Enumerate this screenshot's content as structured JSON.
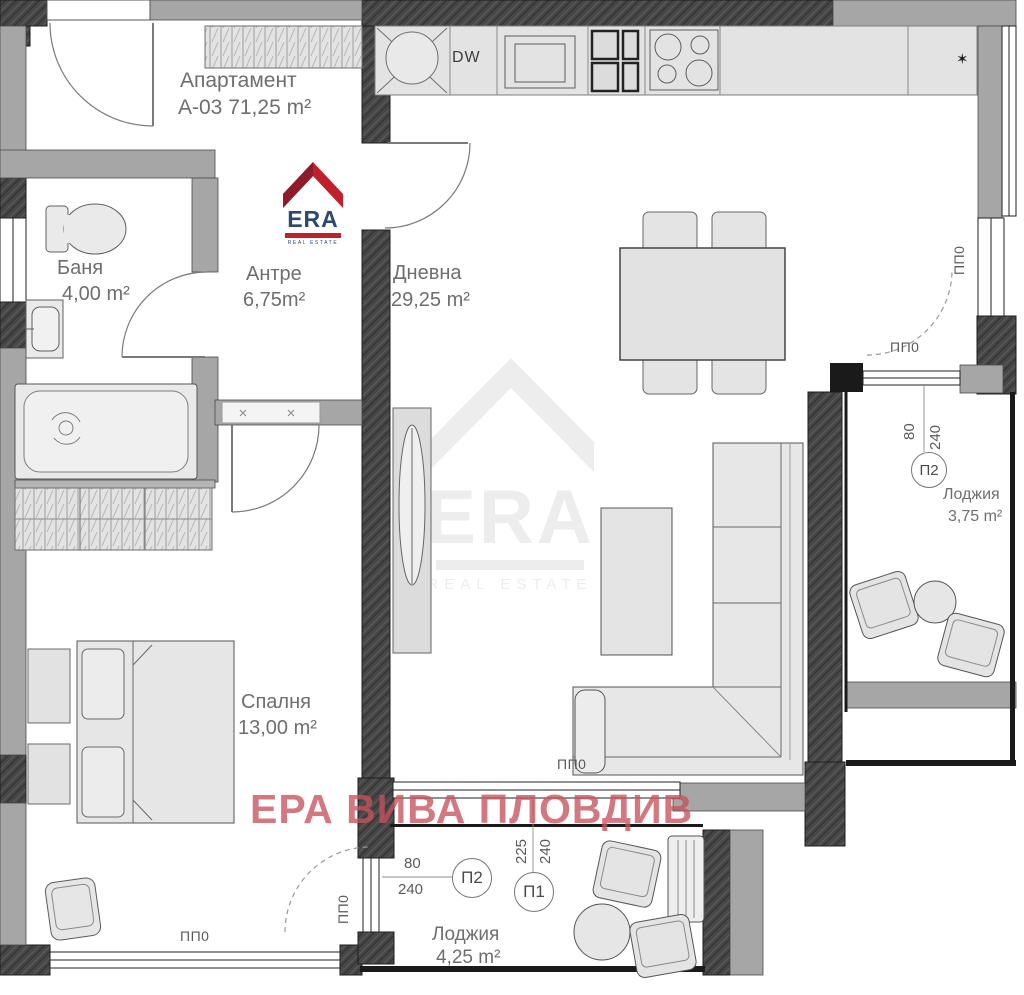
{
  "title": {
    "line1": "Апартамент",
    "line2": "А-03 71,25 m²"
  },
  "rooms": [
    {
      "name": "Баня",
      "area": "4,00 m²"
    },
    {
      "name": "Антре",
      "area": "6,75m²"
    },
    {
      "name": "Дневна",
      "area": "29,25 m²"
    },
    {
      "name": "Спалня",
      "area": "13,00 m²"
    },
    {
      "name": "Лоджия",
      "area": "3,75 m²"
    },
    {
      "name": "Лоджия",
      "area": "4,25 m²"
    }
  ],
  "kitchen": {
    "dishwasher_label": "DW",
    "star_symbol": "✶"
  },
  "window_label": "ПП0",
  "door_markers": {
    "p2_right": {
      "id": "П2",
      "width": "80",
      "height": "240"
    },
    "p2_bottom": {
      "id": "П2",
      "width": "80",
      "height": "240"
    },
    "p1_bottom": {
      "id": "П1",
      "width": "225",
      "height": "240"
    }
  },
  "branding": {
    "logo_text": "ERA",
    "logo_subtext": "REAL ESTATE",
    "watermark_text": "ЕРА ВИВА ПЛОВДИВ",
    "logo_red": "#c0202c",
    "logo_dark_red": "#8e1b28",
    "logo_navy": "#2c4a70",
    "watermark_pink": "#c6525e"
  },
  "colors": {
    "wall_dark": "#454545",
    "wall_gray": "#a6a6a6",
    "furniture": "#e6e6e6"
  }
}
